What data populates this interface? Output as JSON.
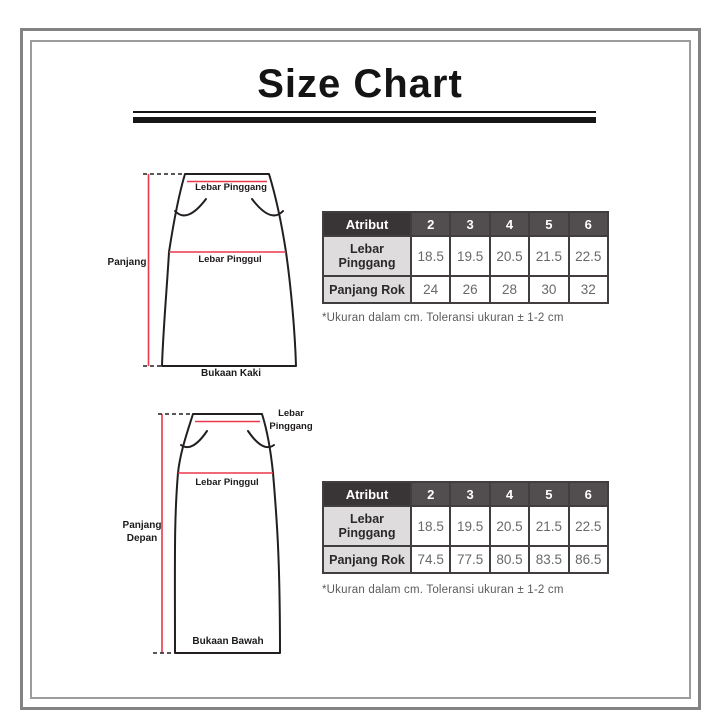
{
  "header": {
    "title": "Size Chart"
  },
  "colors": {
    "accent_red": "#e9394b",
    "outline_black": "#231f20",
    "table_header_attr_bg": "#393435",
    "table_header_size_bg": "#524d4e",
    "table_label_bg": "#dedcdc",
    "table_border": "#423e3f",
    "frame_gray": "#838383"
  },
  "diagram_top": {
    "waist_label": "Lebar Pinggang",
    "hip_label": "Lebar Pinggul",
    "length_label": "Panjang",
    "hem_label": "Bukaan Kaki"
  },
  "diagram_bottom": {
    "waist_label_line1": "Lebar",
    "waist_label_line2": "Pinggang",
    "hip_label": "Lebar Pinggul",
    "length_label_line1": "Panjang",
    "length_label_line2": "Depan",
    "hem_label": "Bukaan Bawah"
  },
  "table_top": {
    "header": [
      "Atribut",
      "2",
      "3",
      "4",
      "5",
      "6"
    ],
    "rows": [
      {
        "label": "Lebar Pinggang",
        "values": [
          "18.5",
          "19.5",
          "20.5",
          "21.5",
          "22.5"
        ]
      },
      {
        "label": "Panjang Rok",
        "values": [
          "24",
          "26",
          "28",
          "30",
          "32"
        ]
      }
    ],
    "note": "*Ukuran dalam cm. Toleransi ukuran ± 1-2 cm"
  },
  "table_bottom": {
    "header": [
      "Atribut",
      "2",
      "3",
      "4",
      "5",
      "6"
    ],
    "rows": [
      {
        "label": "Lebar Pinggang",
        "values": [
          "18.5",
          "19.5",
          "20.5",
          "21.5",
          "22.5"
        ]
      },
      {
        "label": "Panjang Rok",
        "values": [
          "74.5",
          "77.5",
          "80.5",
          "83.5",
          "86.5"
        ]
      }
    ],
    "note": "*Ukuran dalam cm. Toleransi ukuran ± 1-2 cm"
  }
}
